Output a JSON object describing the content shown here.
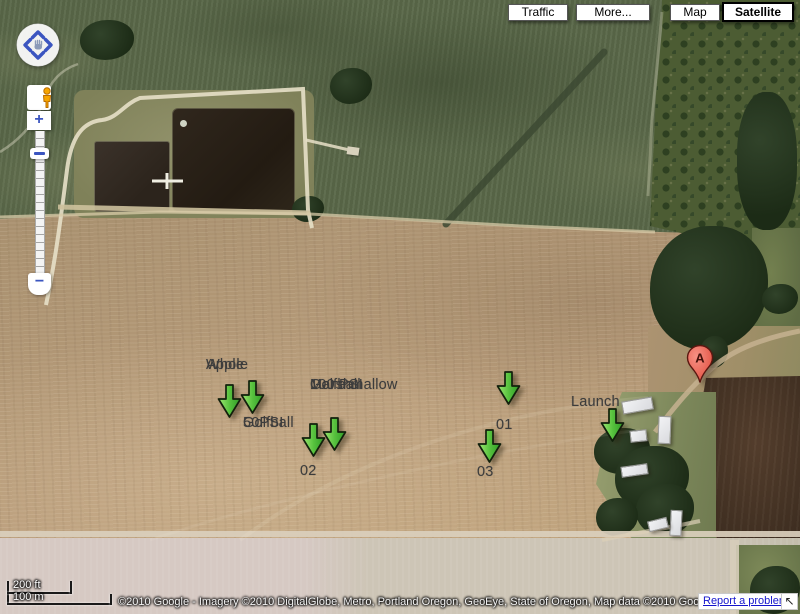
{
  "toolbar": {
    "buttons": [
      {
        "id": "traffic",
        "label": "Traffic",
        "selected": false
      },
      {
        "id": "more",
        "label": "More...",
        "selected": false
      },
      {
        "id": "map",
        "label": "Map",
        "selected": false
      },
      {
        "id": "satellite",
        "label": "Satellite",
        "selected": true
      }
    ]
  },
  "nav_controls": {
    "zoom_in": "+",
    "zoom_out": "−"
  },
  "map_annotations": {
    "labels": [
      {
        "name": "label-whole-apple",
        "lines": [
          "Whole",
          "Apple"
        ],
        "x": 206,
        "y": 356
      },
      {
        "name": "label-50psi-golfball",
        "lines": [
          "50PSI",
          "Golfball"
        ],
        "x": 243,
        "y": 414
      },
      {
        "name": "label-golfball-100psi-marshmallow",
        "lines": [
          "Golfball",
          "100 PSI",
          "Marshmallow"
        ],
        "x": 310,
        "y": 376
      },
      {
        "name": "label-01",
        "lines": [
          "01"
        ],
        "x": 496,
        "y": 416
      },
      {
        "name": "label-02",
        "lines": [
          "02"
        ],
        "x": 300,
        "y": 462
      },
      {
        "name": "label-03",
        "lines": [
          "03"
        ],
        "x": 477,
        "y": 463
      },
      {
        "name": "label-launch",
        "lines": [
          "Launch"
        ],
        "x": 571,
        "y": 393
      }
    ],
    "arrows": [
      {
        "name": "marker-arrow-whole-apple-left",
        "x": 229,
        "y": 417
      },
      {
        "name": "marker-arrow-whole-apple-right",
        "x": 252,
        "y": 413
      },
      {
        "name": "marker-arrow-02-left",
        "x": 313,
        "y": 456
      },
      {
        "name": "marker-arrow-02-right",
        "x": 334,
        "y": 450
      },
      {
        "name": "marker-arrow-01",
        "x": 508,
        "y": 404
      },
      {
        "name": "marker-arrow-03",
        "x": 489,
        "y": 462
      },
      {
        "name": "marker-arrow-launch",
        "x": 612,
        "y": 441
      }
    ],
    "pin": {
      "label": "A",
      "x": 700,
      "y": 383
    }
  },
  "scale_bar": {
    "imperial": "200 ft",
    "metric": "100 m"
  },
  "attribution": {
    "copyright": "©2010 Google - Imagery ©2010 DigitalGlobe, Metro, Portland Oregon, GeoEye, State of Oregon, Map data ©2010 Google - ",
    "terms_link": "Terms of Use",
    "report_link": "Report a problem",
    "pan_return_icon": "↖"
  },
  "colors": {
    "marker_green": "#57c23e",
    "pin_red": "#e8574b",
    "link_blue": "#1414cc",
    "control_blue": "#3b55c0"
  }
}
